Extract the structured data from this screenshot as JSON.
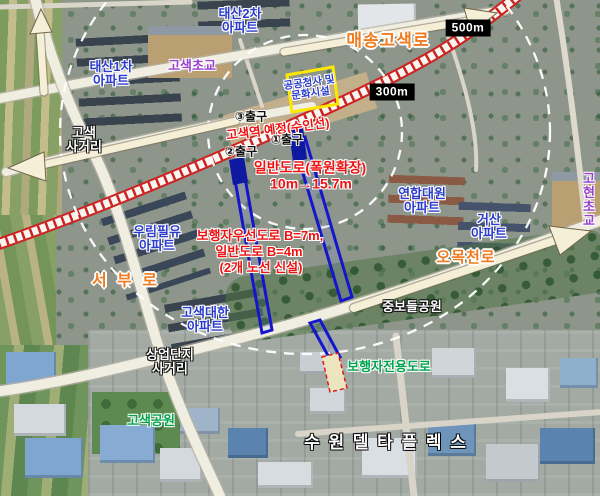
{
  "colors": {
    "apartment_label": "#2b3ccc",
    "school_label": "#9a41cf",
    "road_label": "#f07c22",
    "plan_annotation": "#ee1212",
    "pedestrian_plan": "#00a44c",
    "new_road_outline": "#1515cc",
    "facility_box_border": "#ffe800",
    "railway": "#cc2222"
  },
  "scale_markers": [
    "500m",
    "300m"
  ],
  "station": {
    "label": "고색역 예정(수인선)",
    "exits": [
      "③출구",
      "①출구",
      "②출구"
    ]
  },
  "facility_box": {
    "label": "공공청사 및\n문화시설"
  },
  "plan_annotations": {
    "widen_title": "일반도로(폭원확장)",
    "widen_detail": "10m→15.7m",
    "new_line1": "보행자우선도로 B=7m,",
    "new_line2": "일반도로 B=4m",
    "new_line3": "(2개 노선 신설)",
    "pedestrian_only": "보행자전용도로"
  },
  "roads": [
    "매송고색로",
    "서 부 로",
    "오목천로"
  ],
  "intersections": [
    "고색\n사거리",
    "상업단지\n사거리"
  ],
  "apartments": [
    "태산2차\n아파트",
    "태산1차\n아파트",
    "우림필유\n아파트",
    "고색대한\n아파트",
    "연합대원\n아파트",
    "거산\n아파트"
  ],
  "schools": [
    "고색초교",
    "고현\n초교"
  ],
  "parks": [
    "중보들공원",
    "고색공원"
  ],
  "district": "수 원 델 타 플 렉 스"
}
